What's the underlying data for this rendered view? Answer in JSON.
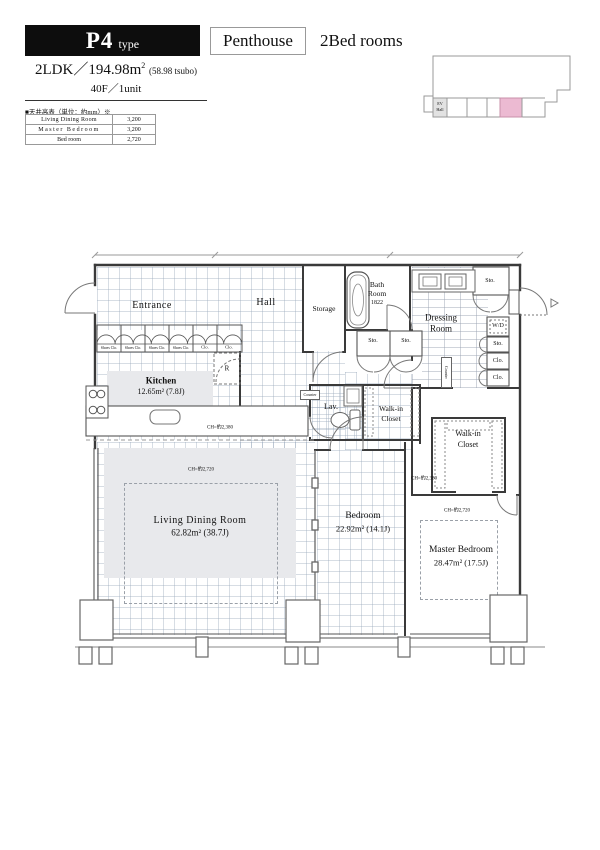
{
  "header": {
    "type_code": "P4",
    "type_suffix": "type",
    "category_box": "Penthouse",
    "category_text": "2Bed rooms",
    "spec_prefix": "2LDK／194.98m",
    "spec_sup": "2",
    "spec_tsubo": "(58.98 tsubo)",
    "spec_floor": "40F／1unit"
  },
  "ceiling_table": {
    "title": "■天井高表（単位：約mm）※",
    "rows": [
      {
        "room": "Living Dining Room",
        "height": "3,200"
      },
      {
        "room": "Master Bedroom",
        "height": "3,200"
      },
      {
        "room": "Bed room",
        "height": "2,720"
      }
    ]
  },
  "key_plan": {
    "ev": "EV",
    "hall": "Hall",
    "highlight_color": "#ecbad2"
  },
  "plan": {
    "rooms": {
      "entrance": "Entrance",
      "hall": "Hall",
      "storage": "Storage",
      "bath_line1": "Bath",
      "bath_line2": "Room",
      "bath_size": "1822",
      "dressing_line1": "Dressing",
      "dressing_line2": "Room",
      "kitchen_name": "Kitchen",
      "kitchen_area": "12.65m² (7.8J)",
      "living_name": "Living Dining Room",
      "living_area": "62.82m² (38.7J)",
      "bedroom_name": "Bedroom",
      "bedroom_area": "22.92m² (14.1J)",
      "master_name": "Master Bedroom",
      "master_area": "28.47m² (17.5J)",
      "wic_line1": "Walk-in",
      "wic_line2": "Closet",
      "lav": "Lav."
    },
    "labels": {
      "sto": "Sto.",
      "clo": "Clo.",
      "shoes_clo": "Shoes Clo.",
      "wd": "W/D",
      "fridge": "R",
      "counter": "Counter",
      "ch_2380": "CH=約2,380",
      "ch_2720": "CH=約2,720"
    }
  }
}
